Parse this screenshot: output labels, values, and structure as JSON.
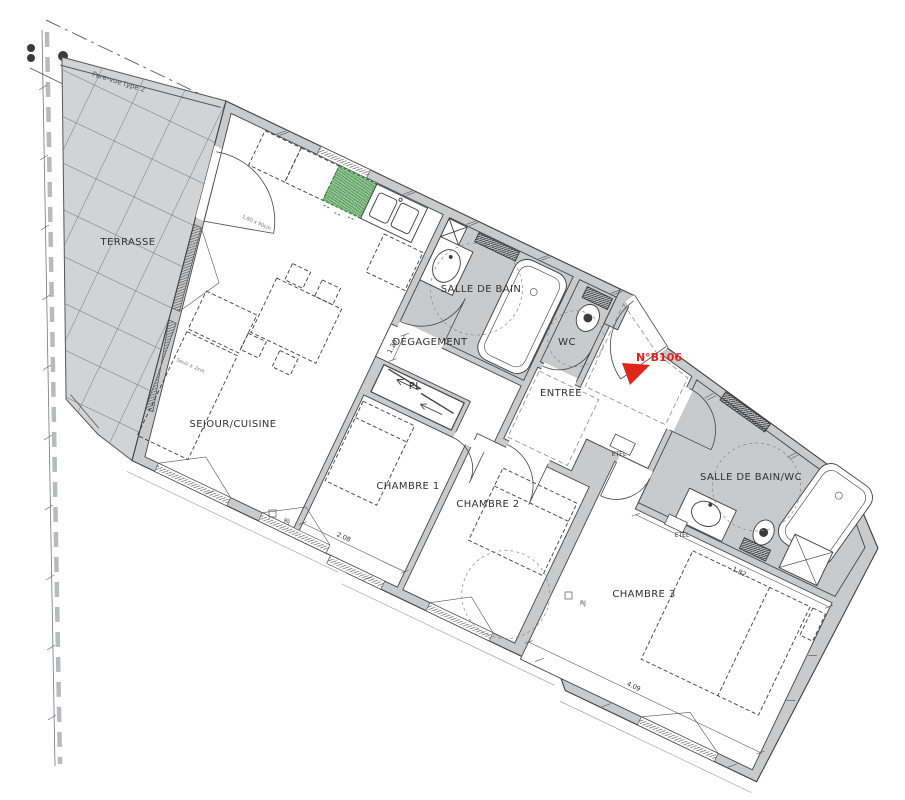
{
  "plan": {
    "unit_label": "N°B106",
    "rooms": {
      "terrasse": "TERRASSE",
      "sejour": "SEJOUR/CUISINE",
      "salle_de_bain": "SALLE DE BAIN",
      "degagement": "DEGAGEMENT",
      "pl": "PL",
      "wc": "WC",
      "entree": "ENTREE",
      "chambre1": "CHAMBRE 1",
      "chambre2": "CHAMBRE 2",
      "chambre3": "CHAMBRE 3",
      "salle_de_bain_wc": "SALLE DE BAIN/WC"
    },
    "annotations": {
      "etel": "ETEL",
      "rj": "RJ",
      "pare_vue": "Pare-vue type 2",
      "seuil": "Seuil ± 2cm",
      "baie": "1,80 x 90cm"
    },
    "dimensions": {
      "chambre1": "2.08",
      "chambre3": "4.09",
      "sdb_wc": "1.82",
      "degagement": "1.20"
    },
    "colors": {
      "wall": "#c9cacc",
      "terrace": "#d2d3d5",
      "marker_red": "#e0251c",
      "appliance_green": "#2e7d32"
    }
  }
}
